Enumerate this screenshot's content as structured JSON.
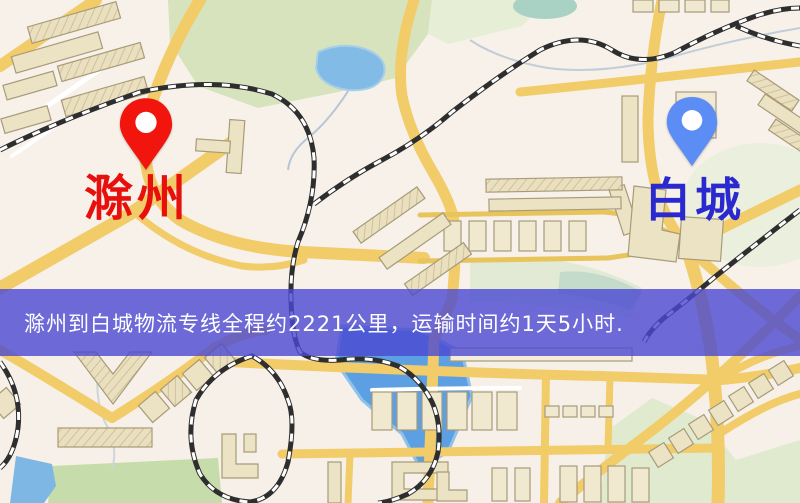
{
  "map": {
    "origin_marker": {
      "name": "滁州",
      "pin_color": "#f2150d",
      "label_color": "#e8100c"
    },
    "destination_marker": {
      "name": "白城",
      "pin_color": "#5b8df4",
      "label_color": "#2a28cf"
    },
    "info_banner": {
      "text": "滁州到白城物流专线全程约2221公里，运输时间约1天5小时.",
      "background_color": "#4b48d2",
      "text_color": "#ffffff"
    },
    "palette": {
      "background": "#f6f0e8",
      "road": "#f1cc69",
      "minor_road": "#ffffff",
      "park": "#d7e3bd",
      "water": "#5c9fe2",
      "building": "#ece3c4",
      "railway": "#2e2e2e"
    }
  }
}
